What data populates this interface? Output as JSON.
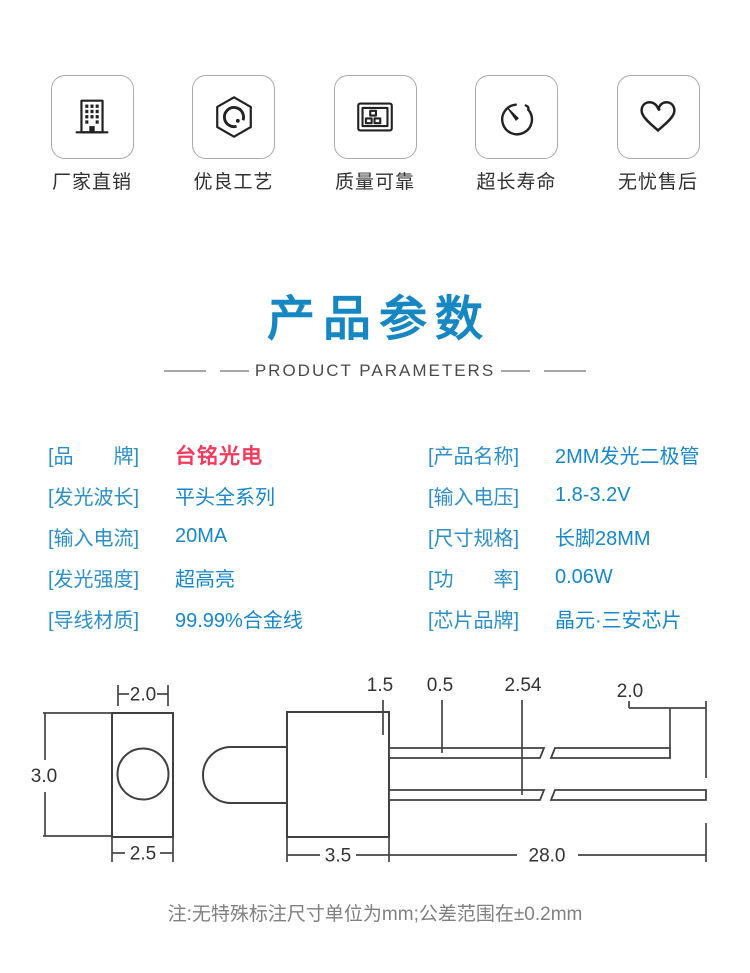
{
  "features": [
    {
      "icon": "building-icon",
      "label": "厂家直销"
    },
    {
      "icon": "craft-badge-icon",
      "label": "优良工艺"
    },
    {
      "icon": "certificate-icon",
      "label": "质量可靠"
    },
    {
      "icon": "timer-icon",
      "label": "超长寿命"
    },
    {
      "icon": "heart-icon",
      "label": "无忧售后"
    }
  ],
  "title": {
    "heading": "产品参数",
    "subheading": "PRODUCT PARAMETERS"
  },
  "parameters": {
    "left": [
      {
        "label": "[品　　牌]",
        "value": "台铭光电"
      },
      {
        "label": "[发光波长]",
        "value": "平头全系列"
      },
      {
        "label": "[输入电流]",
        "value": "20MA"
      },
      {
        "label": "[发光强度]",
        "value": "超高亮"
      },
      {
        "label": "[导线材质]",
        "value": "99.99%合金线"
      }
    ],
    "right": [
      {
        "label": "[产品名称]",
        "value": "2MM发光二极管"
      },
      {
        "label": "[输入电压]",
        "value": "1.8-3.2V"
      },
      {
        "label": "[尺寸规格]",
        "value": "长脚28MM"
      },
      {
        "label": "[功　　率]",
        "value": "0.06W"
      },
      {
        "label": "[芯片品牌]",
        "value": "晶元·三安芯片"
      }
    ]
  },
  "diagram": {
    "front_top_width": "2.0",
    "front_height": "3.0",
    "front_bottom_width": "2.5",
    "flange": "1.5",
    "lead_thickness": "0.5",
    "lead_pitch": "2.54",
    "lead_end_offset": "2.0",
    "body_length": "3.5",
    "lead_length": "28.0"
  },
  "note": "注:无特殊标注尺寸单位为mm;公差范围在±0.2mm",
  "colors": {
    "accent_blue": "#1787c3",
    "label_blue": "#2e8fc6",
    "value_blue": "#1887c8",
    "brand_red": "#f43a5d"
  }
}
